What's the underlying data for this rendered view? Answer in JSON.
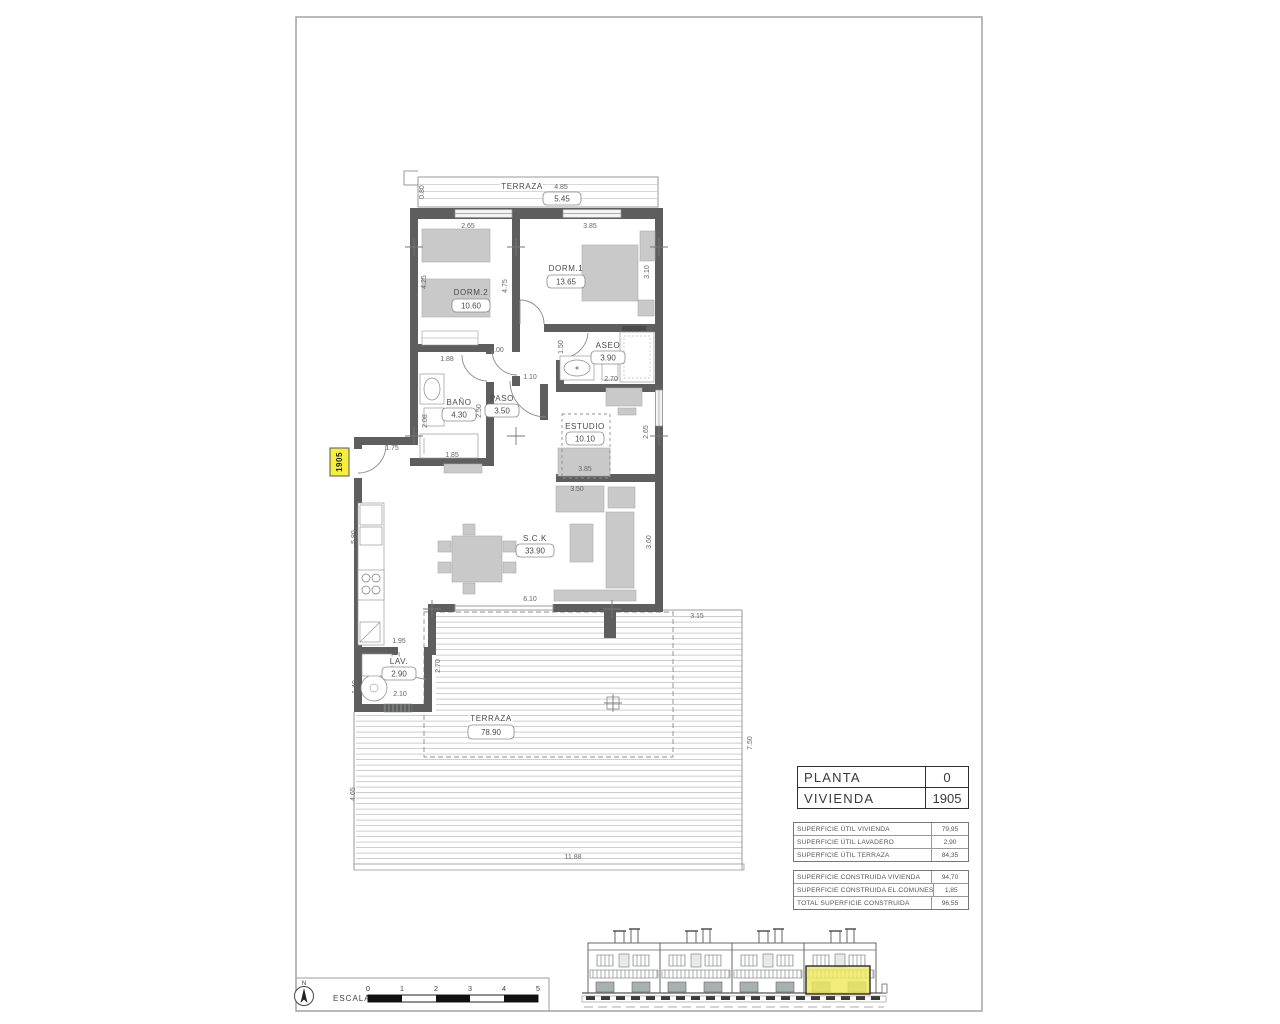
{
  "sheet": {
    "unit_tag": "1905"
  },
  "rooms": {
    "terraza_top": {
      "name": "TERRAZA",
      "area": "5.45",
      "width_dim": "4.85"
    },
    "dorm2": {
      "name": "DORM.2",
      "area": "10.60"
    },
    "dorm1": {
      "name": "DORM.1",
      "area": "13.65"
    },
    "aseo": {
      "name": "ASEO",
      "area": "3.90"
    },
    "bano": {
      "name": "BAÑO",
      "area": "4.30"
    },
    "paso": {
      "name": "PASO",
      "area": "3.50"
    },
    "estudio": {
      "name": "ESTUDIO",
      "area": "10.10"
    },
    "sck": {
      "name": "S.C.K",
      "area": "33.90"
    },
    "lav": {
      "name": "LAV.",
      "area": "2.90"
    },
    "terraza_main": {
      "name": "TERRAZA",
      "area": "78.90"
    }
  },
  "dimensions": [
    {
      "t": "4.85",
      "x": 561,
      "y": 189
    },
    {
      "t": "0.80",
      "x": 424,
      "y": 192,
      "r": -90
    },
    {
      "t": "2.65",
      "x": 468,
      "y": 228
    },
    {
      "t": "3.85",
      "x": 590,
      "y": 228
    },
    {
      "t": "4.25",
      "x": 426,
      "y": 282,
      "r": -90
    },
    {
      "t": "4.75",
      "x": 507,
      "y": 286,
      "r": -90
    },
    {
      "t": "3.10",
      "x": 649,
      "y": 272,
      "r": -90
    },
    {
      "t": "1.88",
      "x": 447,
      "y": 361
    },
    {
      "t": "1.00",
      "x": 497,
      "y": 352
    },
    {
      "t": "1.50",
      "x": 563,
      "y": 347,
      "r": -90
    },
    {
      "t": "1.10",
      "x": 530,
      "y": 379
    },
    {
      "t": "2.70",
      "x": 611,
      "y": 381
    },
    {
      "t": "2.08",
      "x": 427,
      "y": 421,
      "r": -90
    },
    {
      "t": "2.50",
      "x": 481,
      "y": 411,
      "r": -90
    },
    {
      "t": "2.65",
      "x": 648,
      "y": 432,
      "r": -90
    },
    {
      "t": "3.85",
      "x": 585,
      "y": 471
    },
    {
      "t": "3.50",
      "x": 577,
      "y": 491
    },
    {
      "t": "1.85",
      "x": 452,
      "y": 457
    },
    {
      "t": "1.75",
      "x": 392,
      "y": 450
    },
    {
      "t": "5.80",
      "x": 356,
      "y": 537,
      "r": -90
    },
    {
      "t": "1.95",
      "x": 399,
      "y": 643
    },
    {
      "t": "6.10",
      "x": 530,
      "y": 601
    },
    {
      "t": "3.60",
      "x": 651,
      "y": 542,
      "r": -90
    },
    {
      "t": "1.40",
      "x": 357,
      "y": 687,
      "r": -90
    },
    {
      "t": "2.10",
      "x": 400,
      "y": 696
    },
    {
      "t": "2.70",
      "x": 440,
      "y": 666,
      "r": -90
    },
    {
      "t": "3.15",
      "x": 697,
      "y": 618
    },
    {
      "t": "7.50",
      "x": 752,
      "y": 743,
      "r": -90
    },
    {
      "t": "4.65",
      "x": 355,
      "y": 794,
      "r": -90
    },
    {
      "t": "11.88",
      "x": 573,
      "y": 859
    }
  ],
  "title_block": {
    "planta": {
      "label": "PLANTA",
      "value": "0"
    },
    "vivienda": {
      "label": "VIVIENDA",
      "value": "1905"
    },
    "util": [
      {
        "label": "SUPERFICIE ÚTIL VIVIENDA",
        "value": "79,95"
      },
      {
        "label": "SUPERFICIE ÚTIL LAVADERO",
        "value": "2,90"
      },
      {
        "label": "SUPERFICIE ÚTIL TERRAZA",
        "value": "84,35"
      }
    ],
    "construida": [
      {
        "label": "SUPERFICIE CONSTRUIDA VIVIENDA",
        "value": "94,70"
      },
      {
        "label": "SUPERFICIE CONSTRUIDA EL.COMUNES",
        "value": "1,85"
      },
      {
        "label": "TOTAL SUPERFICIE CONSTRUIDA",
        "value": "96,55"
      }
    ]
  },
  "scale_bar": {
    "label": "ESCALA :",
    "north": "N",
    "ticks": [
      "0",
      "1",
      "2",
      "3",
      "4",
      "5"
    ]
  },
  "colors": {
    "wall": "#5e5e5e",
    "highlight_yellow": "#efe95e",
    "furniture": "#c9c9c9"
  }
}
